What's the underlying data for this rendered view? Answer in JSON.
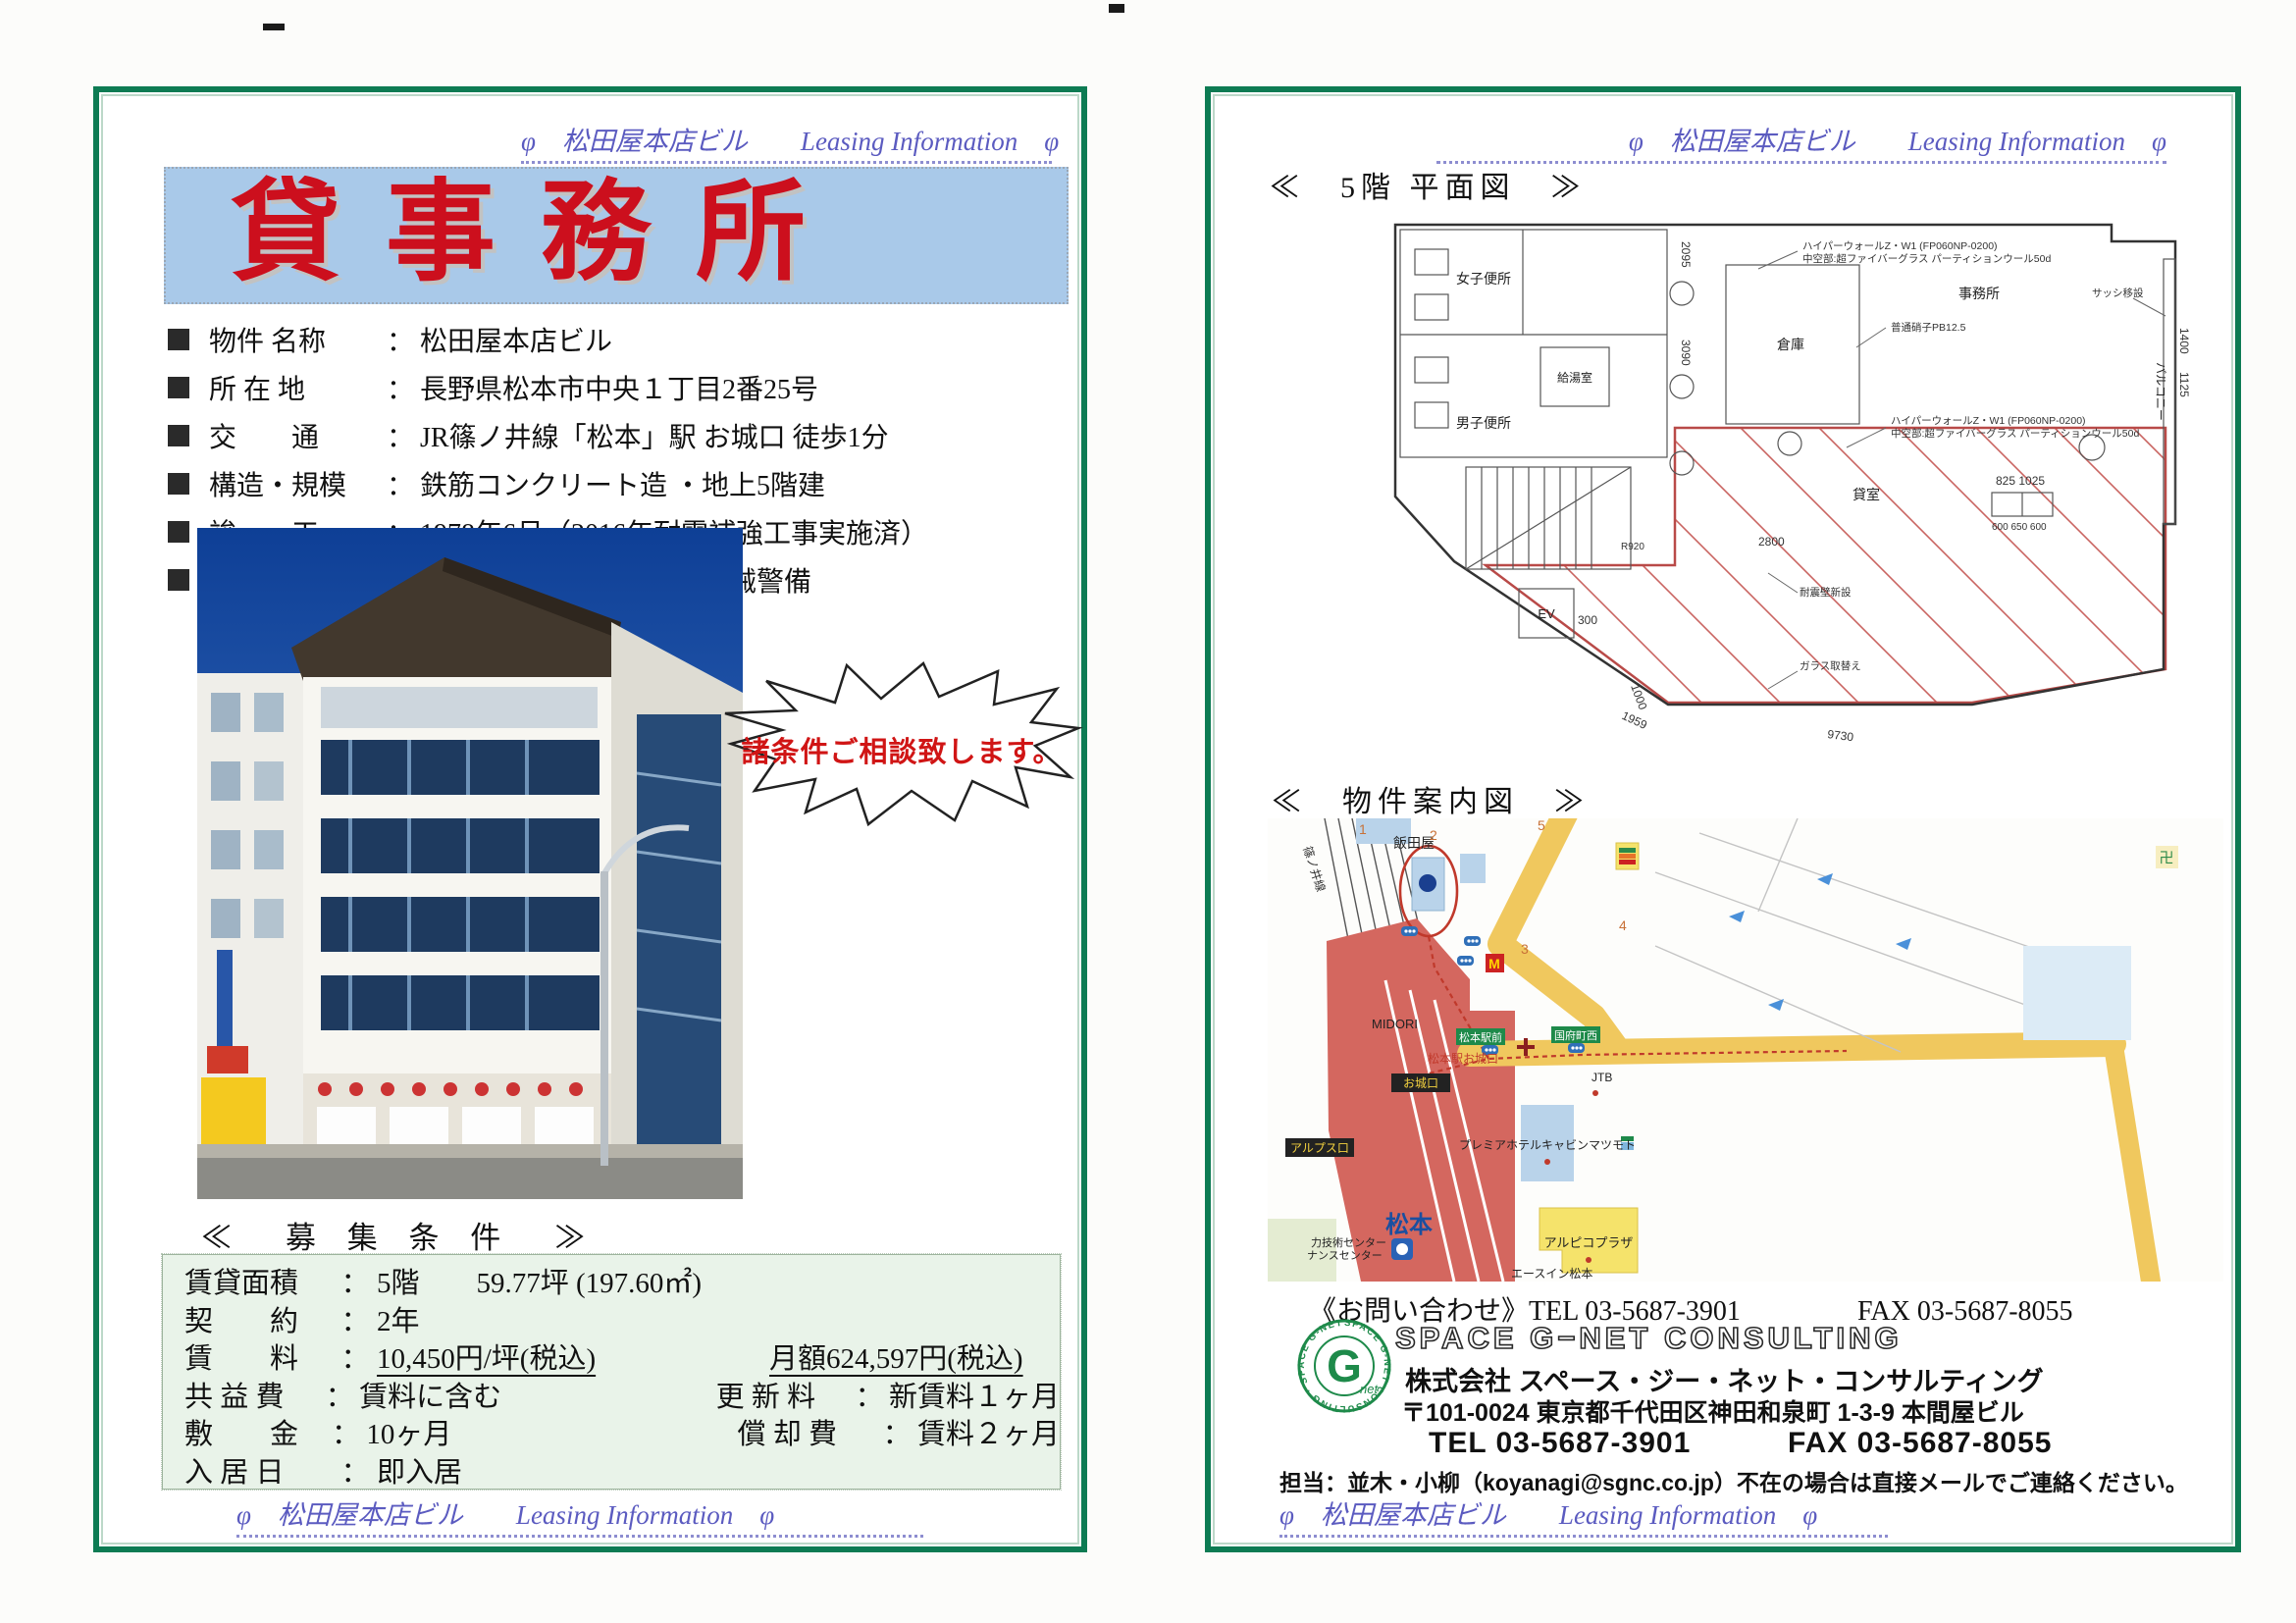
{
  "doc": {
    "running_text": "φ　松田屋本店ビル　　Leasing Information　φ",
    "colon": "："
  },
  "left_page": {
    "title": "貸事務所",
    "details": [
      {
        "label": "物件 名称",
        "value": "松田屋本店ビル"
      },
      {
        "label": "所 在 地",
        "value": "長野県松本市中央１丁目2番25号"
      },
      {
        "label": "交　　通",
        "value": "JR篠ノ井線「松本」駅 お城口 徒歩1分"
      },
      {
        "label": "構造・規模",
        "value": "鉄筋コンクリート造 ・地上5階建"
      },
      {
        "label": "竣　　工",
        "value": "1978年6月（2016年耐震補強工事実施済）"
      },
      {
        "label": "主要 設備",
        "value": "エレベータ 個別空調　機械警備"
      }
    ],
    "bubble": "諸条件ご相談致します。",
    "conditions_title": "≪　募 集 条 件　≫",
    "conditions": [
      {
        "label": "賃貸面積",
        "value": "5階　　59.77坪 (197.60㎡)"
      },
      {
        "label": "契　　約",
        "value": "2年"
      },
      {
        "label": "賃　　料",
        "value": "10,450円/坪(税込)",
        "value2": "月額624,597円(税込)"
      },
      {
        "label": "共 益 費",
        "value": "賃料に含む",
        "label2": "更 新 料",
        "value2": "新賃料１ヶ月"
      },
      {
        "label": "敷　　金",
        "value": "10ヶ月",
        "label2": "償 却 費",
        "value2": "賃料２ヶ月"
      },
      {
        "label": "入 居 日",
        "value": "即入居"
      }
    ]
  },
  "right_page": {
    "plan_title": "≪　5階 平面図　≫",
    "plan": {
      "rooms": {
        "womens": "女子便所",
        "mens": "男子便所",
        "kitchenette": "給湯室",
        "storage": "倉庫",
        "office": "事務所",
        "balcony": "バルコニー",
        "elevator": "EV",
        "rental": "貸室"
      },
      "notes": {
        "wall1": "ハイパーウォールZ・W1 (FP060NP-0200)",
        "wall2": "中空部:超ファイバーグラス パーティションウール50d",
        "glass": "普通硝子PB12.5",
        "sash": "サッシ移設",
        "quake": "耐震壁新設",
        "replace": "ガラス取替え"
      },
      "dims": {
        "d2800": "2800",
        "d300": "300",
        "d9730": "9730",
        "d1959": "1959",
        "d1000": "1000",
        "d1400": "1400",
        "d1125": "1125",
        "d2095": "2095",
        "d3090": "3090",
        "d825": "825  1025",
        "d600": "600 650 600",
        "r920": "R920"
      }
    },
    "map_title": "≪　物件案内図　≫",
    "map": {
      "iidaya": "飯田屋",
      "railline": "篠ノ井線",
      "midori": "MIDORI",
      "station": "松本",
      "alps_exit": "アルプス口",
      "castle_exit": "お城口",
      "station_castle": "松本駅お城口",
      "ekimae": "松本駅前",
      "kokufu": "国府町西",
      "jtb": "JTB",
      "hotel": "プレミアホテルキャビンマツモト",
      "plaza": "アルピコプラザ",
      "aceinn": "エースイン松本",
      "center1": "力技術センター",
      "center2": "ナンスセンター",
      "n1": "1",
      "n2": "2",
      "n3": "3",
      "n4": "4",
      "n5": "5",
      "temple": "卍",
      "mcdonalds": "M",
      "seven": "7"
    },
    "contact": {
      "inquiry_label": "《お問い合わせ》",
      "tel": "TEL 03-5687-3901",
      "fax": "FAX 03-5687-8055",
      "brand": "SPACE G−NET CONSULTING",
      "company": "株式会社 スペース・ジー・ネット・コンサルティング",
      "address": "〒101-0024 東京都千代田区神田和泉町 1-3-9 本間屋ビル",
      "person": "担当：並木・小柳（koyanagi@sgnc.co.jp）不在の場合は直接メールでご連絡ください。",
      "logo_g": "G",
      "logo_net": "net",
      "logo_ring": "SPACE G-NET CONSULTING · SPACE G-NET"
    }
  }
}
